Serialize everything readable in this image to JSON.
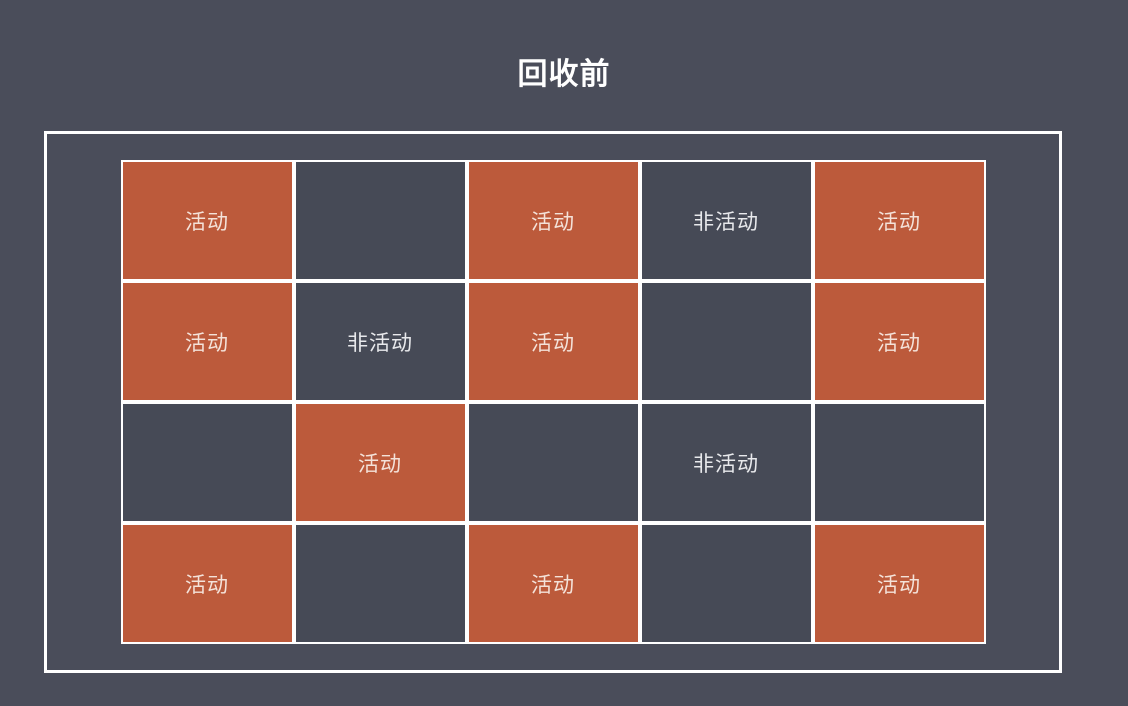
{
  "title": "回收前",
  "labels": {
    "active": "活动",
    "inactive": "非活动"
  },
  "colors": {
    "background": "#4a4d5a",
    "cell_dark": "#464a56",
    "cell_active": "#bc5a3b",
    "border": "#ffffff",
    "title_text": "#ffffff",
    "active_text": "#f4e2d9",
    "inactive_text": "#e8e9ec"
  },
  "grid": {
    "columns": 5,
    "rows": 4,
    "cells": [
      {
        "label": "活动",
        "state": "active"
      },
      {
        "label": "",
        "state": "empty"
      },
      {
        "label": "活动",
        "state": "active"
      },
      {
        "label": "非活动",
        "state": "inactive"
      },
      {
        "label": "活动",
        "state": "active"
      },
      {
        "label": "活动",
        "state": "active"
      },
      {
        "label": "非活动",
        "state": "inactive"
      },
      {
        "label": "活动",
        "state": "active"
      },
      {
        "label": "",
        "state": "empty"
      },
      {
        "label": "活动",
        "state": "active"
      },
      {
        "label": "",
        "state": "empty"
      },
      {
        "label": "活动",
        "state": "active"
      },
      {
        "label": "",
        "state": "empty"
      },
      {
        "label": "非活动",
        "state": "inactive"
      },
      {
        "label": "",
        "state": "empty"
      },
      {
        "label": "活动",
        "state": "active"
      },
      {
        "label": "",
        "state": "empty"
      },
      {
        "label": "活动",
        "state": "active"
      },
      {
        "label": "",
        "state": "empty"
      },
      {
        "label": "活动",
        "state": "active"
      }
    ]
  }
}
